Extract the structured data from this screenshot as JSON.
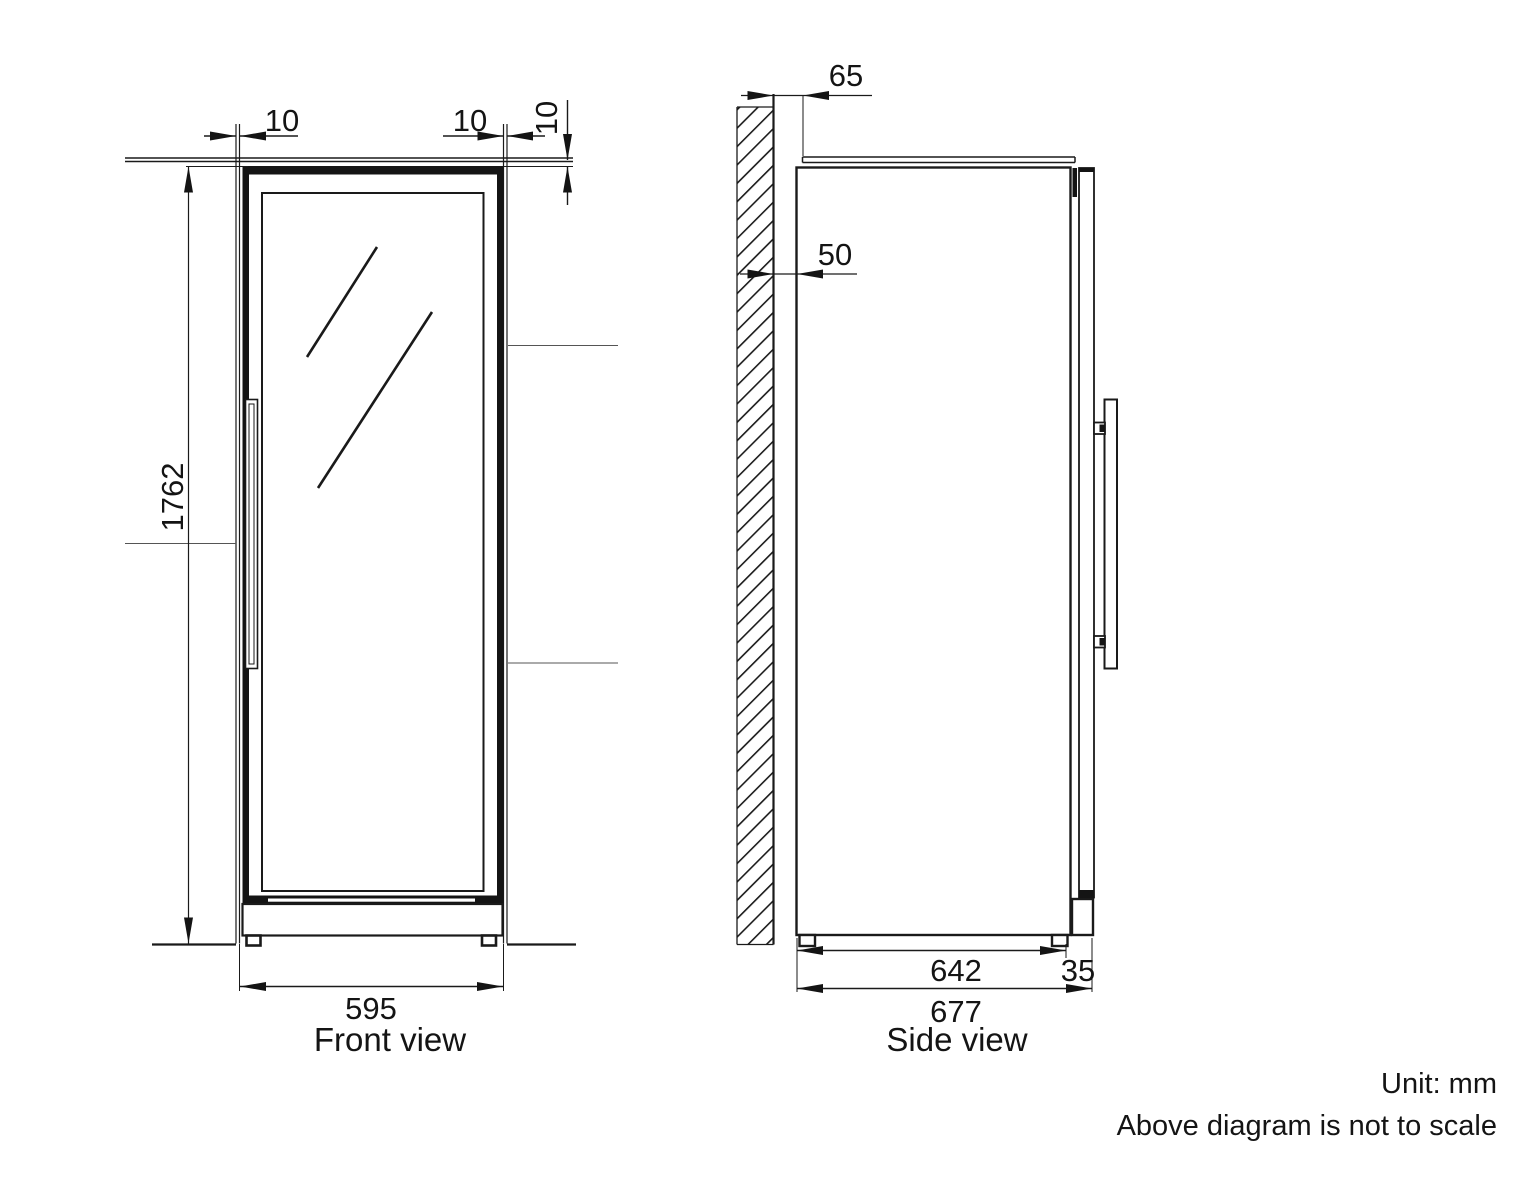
{
  "front_view": {
    "caption": "Front view",
    "dims": {
      "top_left_gap": "10",
      "top_right_gap": "10",
      "top_vertical_gap": "10",
      "height": "1762",
      "width": "595"
    }
  },
  "side_view": {
    "caption": "Side view",
    "dims": {
      "top_rear_clearance": "65",
      "wall_clearance": "50",
      "body_depth": "642",
      "door_thickness": "35",
      "total_depth": "677"
    }
  },
  "notes": {
    "unit": "Unit: mm",
    "scale": "Above diagram is not to scale"
  },
  "colors": {
    "line": "#141414",
    "background": "#ffffff"
  }
}
